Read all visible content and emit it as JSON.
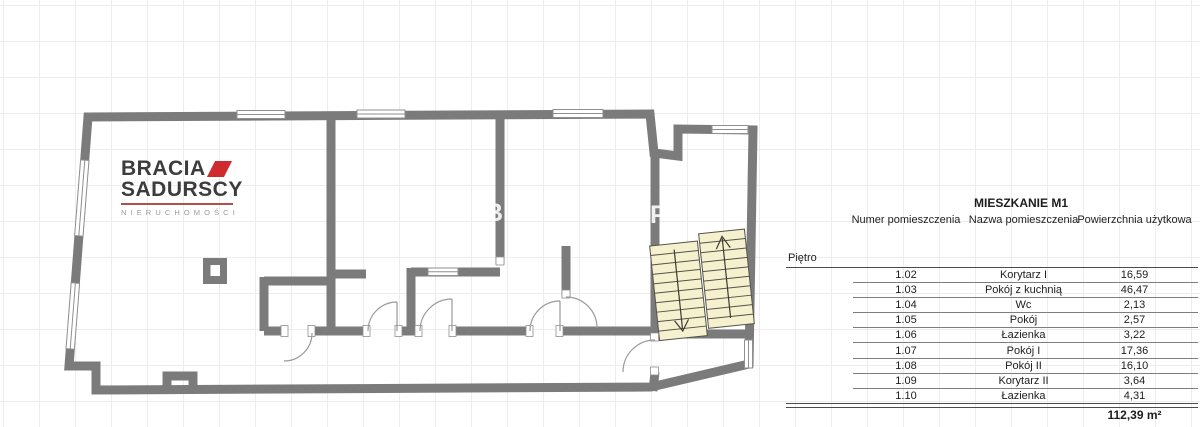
{
  "logo": {
    "line1": "BRACIA",
    "line2": "SADURSCY",
    "subtitle": "NIERUCHOMOŚCI"
  },
  "watermark": {
    "letters": [
      "B",
      "P"
    ]
  },
  "table": {
    "title": "MIESZKANIE M1",
    "columns": [
      "Numer pomieszczenia",
      "Nazwa pomieszczenia",
      "Powierzchnia użytkowa"
    ],
    "floor_label": "Piętro",
    "rows": [
      {
        "num": "1.02",
        "name": "Korytarz I",
        "area": "16,59"
      },
      {
        "num": "1.03",
        "name": "Pokój z kuchnią",
        "area": "46,47"
      },
      {
        "num": "1.04",
        "name": "Wc",
        "area": "2,13"
      },
      {
        "num": "1.05",
        "name": "Pokój",
        "area": "2,57"
      },
      {
        "num": "1.06",
        "name": "Łazienka",
        "area": "3,22"
      },
      {
        "num": "1.07",
        "name": "Pokój I",
        "area": "17,36"
      },
      {
        "num": "1.08",
        "name": "Pokój II",
        "area": "16,10"
      },
      {
        "num": "1.09",
        "name": "Korytarz II",
        "area": "3,64"
      },
      {
        "num": "1.10",
        "name": "Łazienka",
        "area": "4,31"
      }
    ],
    "total_area": "112,39 m²"
  },
  "colors": {
    "wall": "#7b7b7b",
    "stairs": "#f5f1ce",
    "stairline": "#55524a",
    "grid": "#efecec",
    "red": "#cf2b2e",
    "linedark": "#4c4c4c",
    "linelight": "#7e7e7e",
    "text": "#222222"
  }
}
